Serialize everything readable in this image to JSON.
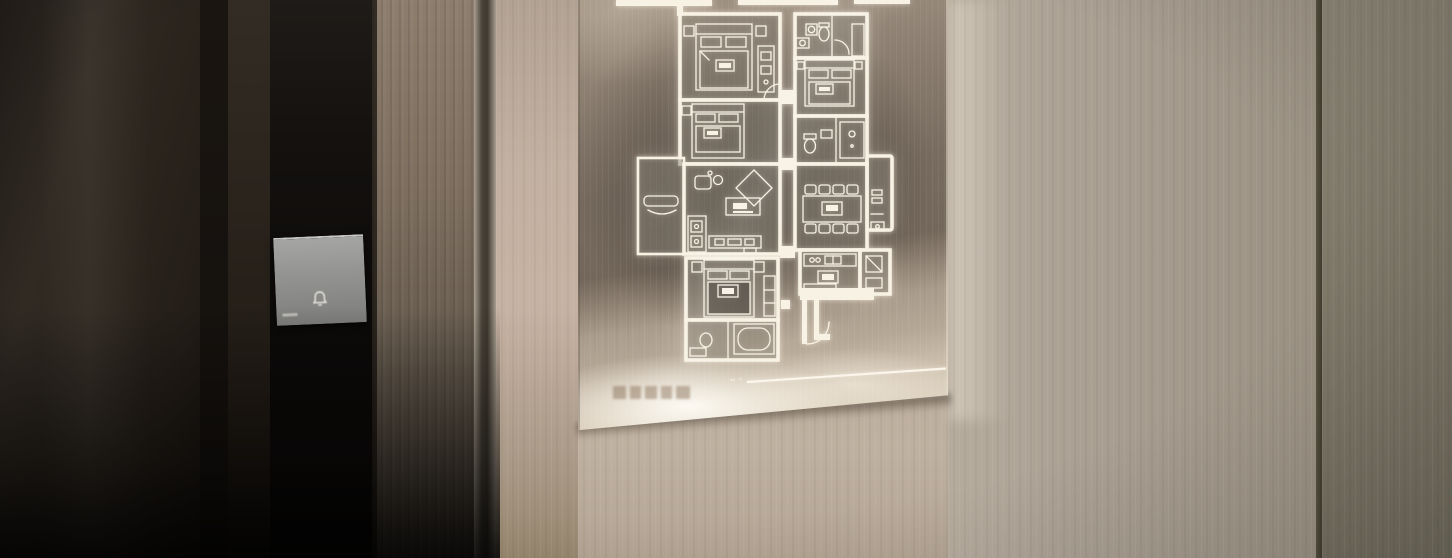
{
  "scene": {
    "kind": "photograph",
    "subjects": [
      "entry-door",
      "doorbell-button",
      "backlit-floor-plan-plaque",
      "wood-paneled-wall"
    ]
  },
  "doorbell": {
    "icon": "bell-icon",
    "has_bottom_dash": true
  },
  "plaque": {
    "caption": {
      "legible": false,
      "block_widths": [
        13,
        11,
        12,
        11,
        14
      ],
      "block_gap": 4
    },
    "has_divider_rule": true,
    "floor_plan_rooms": [
      "bedroom-1",
      "bedroom-2",
      "bathroom-1",
      "bedroom-3",
      "bathroom-2",
      "utility-shaft",
      "balcony",
      "living-room",
      "dining-room",
      "master-bedroom",
      "master-bathroom",
      "kitchen",
      "fridge-nook",
      "entry-hall"
    ]
  },
  "colors": {
    "door_leaf": "#28221c",
    "door_gap": "#15110e",
    "door_frame": "#2c261f",
    "bell_strip": "#100e0c",
    "bell_plate": "#8f8f8d",
    "jamb_top": "#8d7d6d",
    "jamb_bottom": "#453d33",
    "seam_dark": "#4a443a",
    "wall_light": "#bcab9c",
    "wall_mid": "#a89e90",
    "wall_far": "#7d7869",
    "panel_light": "#a09181",
    "panel_dark": "#6f6458",
    "panel_glow": "#f3ead9",
    "plan_line": "#f8f2e5"
  }
}
